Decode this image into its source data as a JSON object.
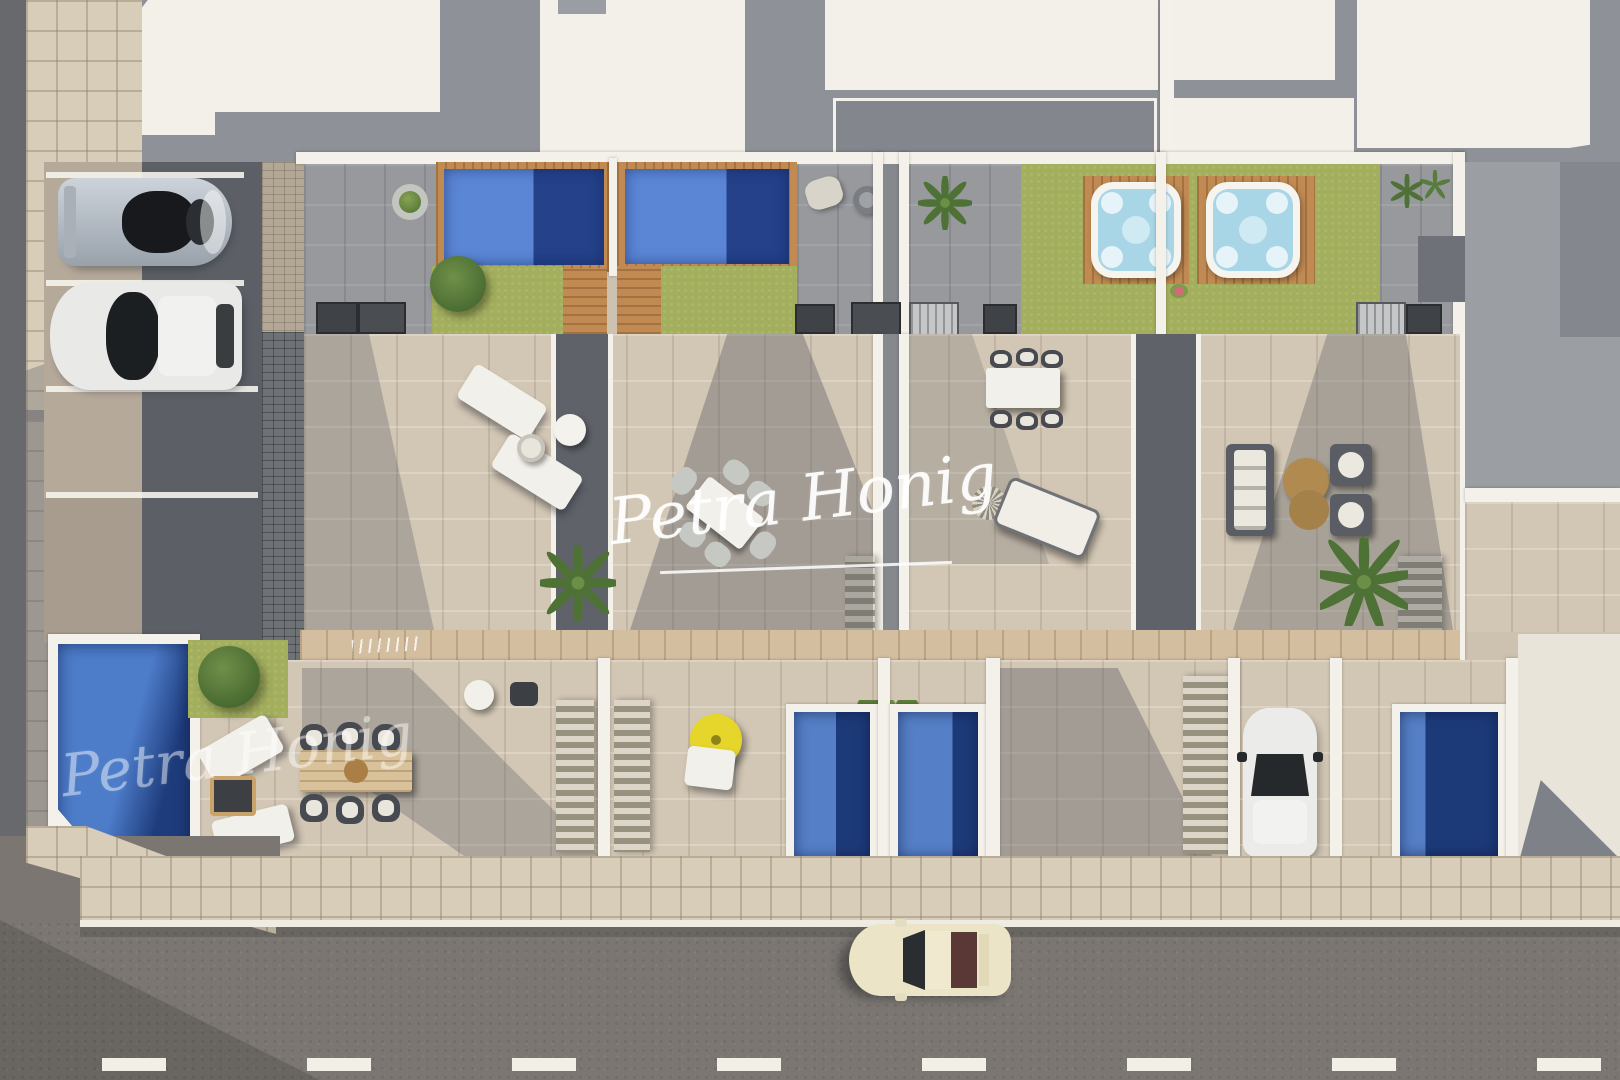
{
  "watermark": {
    "text": "Petra Honig"
  },
  "palette": {
    "roof_white": "#f3f0e9",
    "wall_white": "#f4f1ea",
    "roof_shadow_gray": "#8e9197",
    "terrace_beige": "#d2c6b4",
    "terrace_gray": "#97999d",
    "walkway_dark_gray": "#5f6369",
    "lawn_green": "#a3af5d",
    "pool_water_light": "#557fc6",
    "pool_water_dark": "#1d3a78",
    "rooftop_pool_light": "#5b86d6",
    "rooftop_pool_dark": "#24418a",
    "wood_deck": "#c08a52",
    "walkway_wood": "#d3bf9f",
    "hot_tub_water": "#a9d6e6",
    "road_asphalt": "#7b7672",
    "lane_marking": "#f2efe6",
    "sidewalk_tile": "#d8cdb9",
    "car_silver": "#b9c2cc",
    "car_white": "#e9e9e7",
    "car_cream": "#ece4c6",
    "parasol_yellow": "#e6d52a",
    "sofa_dark": "#5a5e64",
    "coffee_table_brown": "#b08a4e"
  },
  "scene": {
    "type": "aerial 3D architectural render",
    "features": [
      "rooftop pools",
      "hot tubs",
      "roof terraces",
      "street with car",
      "parking bays with two cars",
      "private plunge pools",
      "driveway with car"
    ]
  }
}
